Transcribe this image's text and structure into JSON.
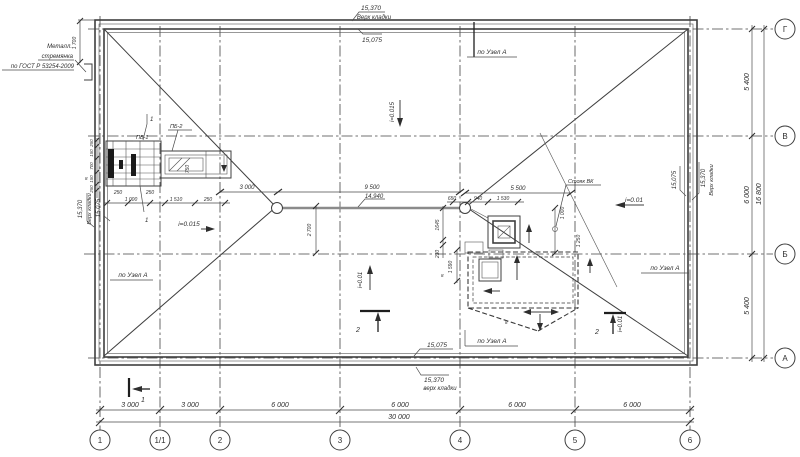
{
  "colors": {
    "line": "#3f3f3f",
    "text": "#2e2e2e",
    "gutter_line": "#8b8b8b",
    "background": "#ffffff"
  },
  "axes": {
    "bottom": [
      {
        "label": "1"
      },
      {
        "label": "1/1"
      },
      {
        "label": "2"
      },
      {
        "label": "3"
      },
      {
        "label": "4"
      },
      {
        "label": "5"
      },
      {
        "label": "6"
      }
    ],
    "right": [
      {
        "label": "Г"
      },
      {
        "label": "В"
      },
      {
        "label": "Б"
      },
      {
        "label": "А"
      }
    ]
  },
  "dims": {
    "bottom_segments": [
      "3 000",
      "3 000",
      "6 000",
      "6 000",
      "6 000",
      "6 000"
    ],
    "bottom_total": "30 000",
    "right_segments": [
      "5 400",
      "6 000",
      "5 400"
    ],
    "right_total": "16 800",
    "plan": {
      "d3000": "3 000",
      "d9500": "9 500",
      "d5500": "5 500",
      "d650": "650",
      "d940": "940",
      "d1530": "1 530",
      "d1645": "1645",
      "d230": "230",
      "d2700": "2 700",
      "d1590": "1 590",
      "d1000": "1 000",
      "d1250": "1 250",
      "d1700": "1 700",
      "d750": "750"
    },
    "detail_bottom": [
      "250",
      "1 000",
      "250",
      "1 510",
      "250"
    ],
    "detail_left": [
      "250",
      "150",
      "700",
      "150",
      "250"
    ]
  },
  "elevations": {
    "top_value": "15,370",
    "top_label": "Верх кладки",
    "top_label_lc": "верх кладки",
    "roof_value": "15,075",
    "gutter_value": "14,940"
  },
  "slopes": {
    "s0015": "i=0.015",
    "s001": "i=0.01"
  },
  "notes": {
    "ladder_line1": "Металл.",
    "ladder_line2": "стремянка",
    "ladder_line3": "по ГОСТ Р 53254-2009",
    "node_a": "по Узел А",
    "riser": "Стояк ВК"
  },
  "callouts": {
    "pos1": "1",
    "pb1": "ПБ-1",
    "pb2": "ПБ-2",
    "sec1": "1",
    "sec2": "2",
    "small8": "8"
  }
}
